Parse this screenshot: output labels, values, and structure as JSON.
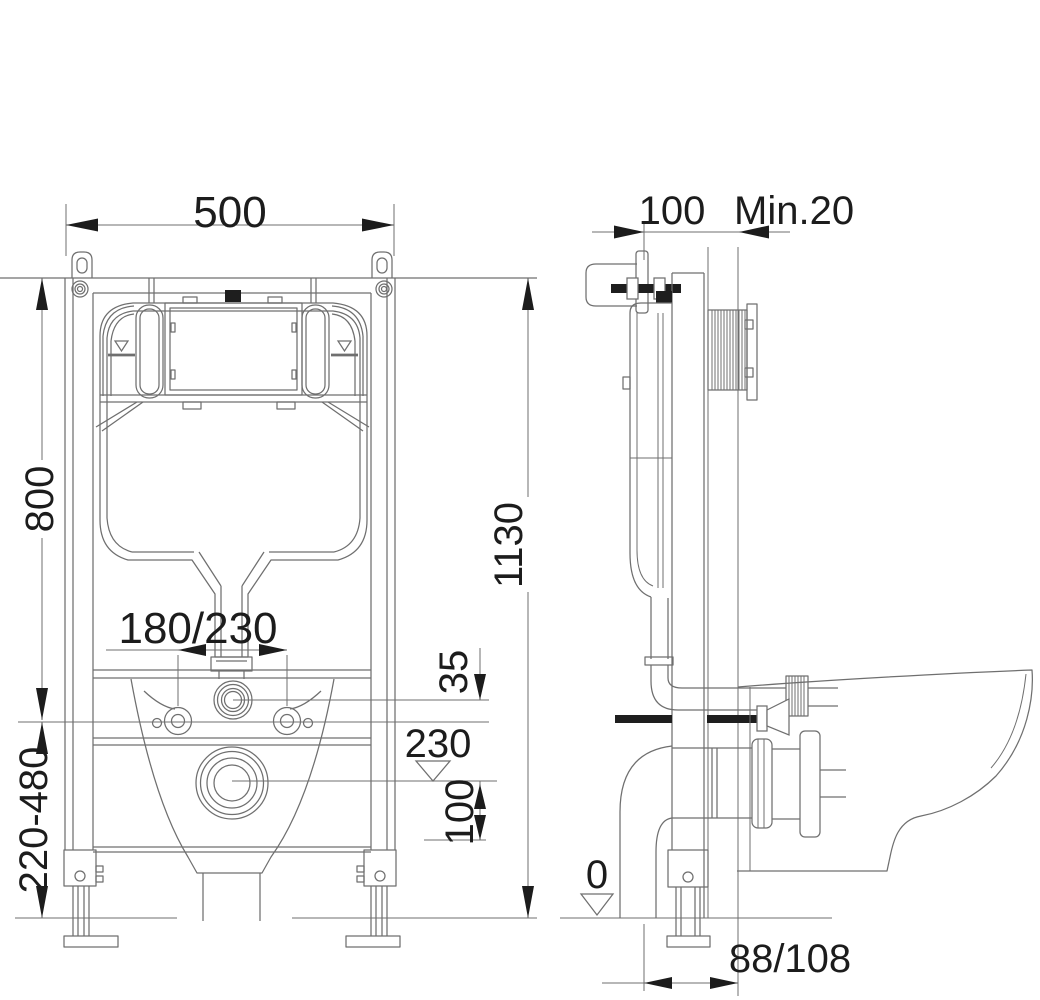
{
  "drawing": {
    "type": "technical-installation-diagram",
    "subject": "concealed cistern wall-hung toilet frame",
    "front_view": {
      "dimensions": {
        "frame_width": "500",
        "cistern_height": "800",
        "total_height": "1130",
        "leg_adjust_range": "220-480",
        "fixing_bolt_centers": "180/230",
        "flush_offset": "35",
        "outlet_center_height": "230",
        "outlet_offset": "100"
      }
    },
    "side_view": {
      "dimensions": {
        "frame_depth": "100",
        "wall_min_thickness": "Min.20",
        "floor_datum": "0",
        "outlet_setback": "88/108"
      }
    },
    "colors": {
      "line": "#6f6f6f",
      "text": "#1c1c1c",
      "background": "#ffffff"
    }
  }
}
